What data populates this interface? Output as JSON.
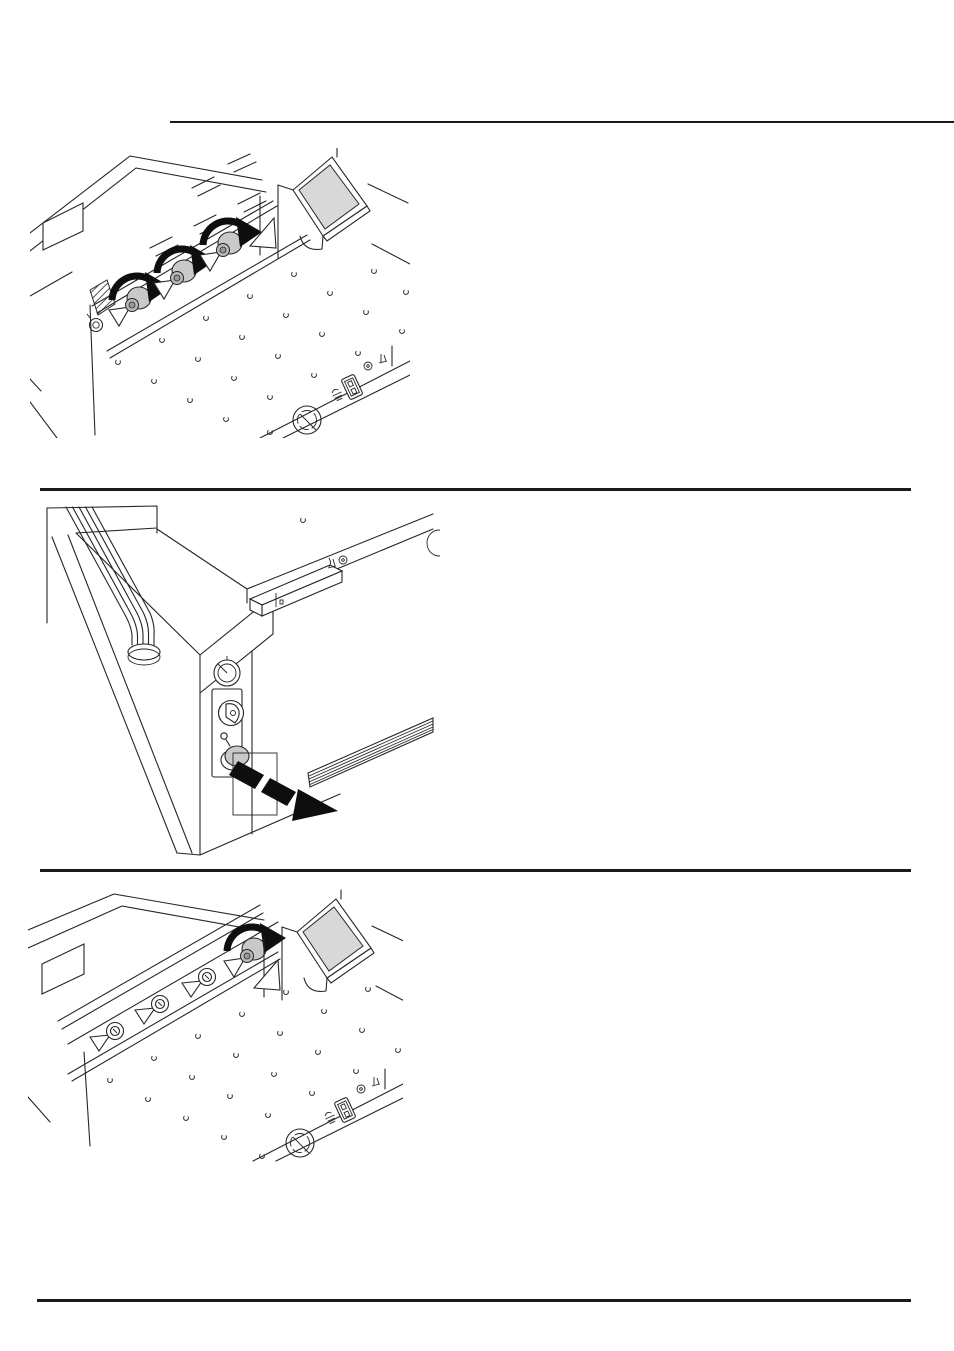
{
  "page": {
    "kind": "operating-manual-page",
    "background": "#ffffff",
    "visible_text": ""
  },
  "colors": {
    "line": "#262626",
    "rule": "#1a1a1a",
    "screen": "#d8d8d8",
    "knob": "#c9c9c9",
    "arrow": "#0e0e0e"
  },
  "separators": {
    "count": 4,
    "style": "thin black horizontal rules dividing the page into illustration sections"
  },
  "figures": [
    {
      "id": "fig-1",
      "name": "loosen-clamp-knobs",
      "description": "Guillotine paper cutter, front isometric view: three gray clamp knobs on the blade bar, each turned as shown by a thick black curved rotation arrow; tilted display screen on its stand at the right; perforated air table with small open-circle nozzles; lower-right control strip with hand-warning icon, rocker power switch and round dial.",
      "icons": [
        "rotation-arrow-icon",
        "clamp-knob",
        "display-screen",
        "air-nozzle-holes",
        "hand-warning-icon",
        "power-switch-icon",
        "dial-knob"
      ]
    },
    {
      "id": "fig-2",
      "name": "pull-out-blade-carrier",
      "description": "Front-left corner view of the machine: cable conduit running down onto the table, storage bar on the tabletop, side panel with pressure gauge, key switch and gray release knob; a thick black dashed arrow points outward showing the blade carrier strip being pulled out of the machine side.",
      "icons": [
        "pressure-gauge-icon",
        "key-switch-icon",
        "release-knob",
        "pull-direction-arrow-icon",
        "blade-carrier",
        "cable-conduit"
      ]
    },
    {
      "id": "fig-3",
      "name": "turn-end-knob",
      "description": "Guillotine paper cutter, front isometric view with the blade bar exposed: flat blade screws along the bar and the end knob turned as shown by a single black curved rotation arrow; tilted display screen at the right; perforated air table; lower-right control strip with switch and dial.",
      "icons": [
        "rotation-arrow-icon",
        "blade-screw",
        "display-screen",
        "air-nozzle-holes",
        "power-switch-icon",
        "dial-knob"
      ]
    }
  ]
}
